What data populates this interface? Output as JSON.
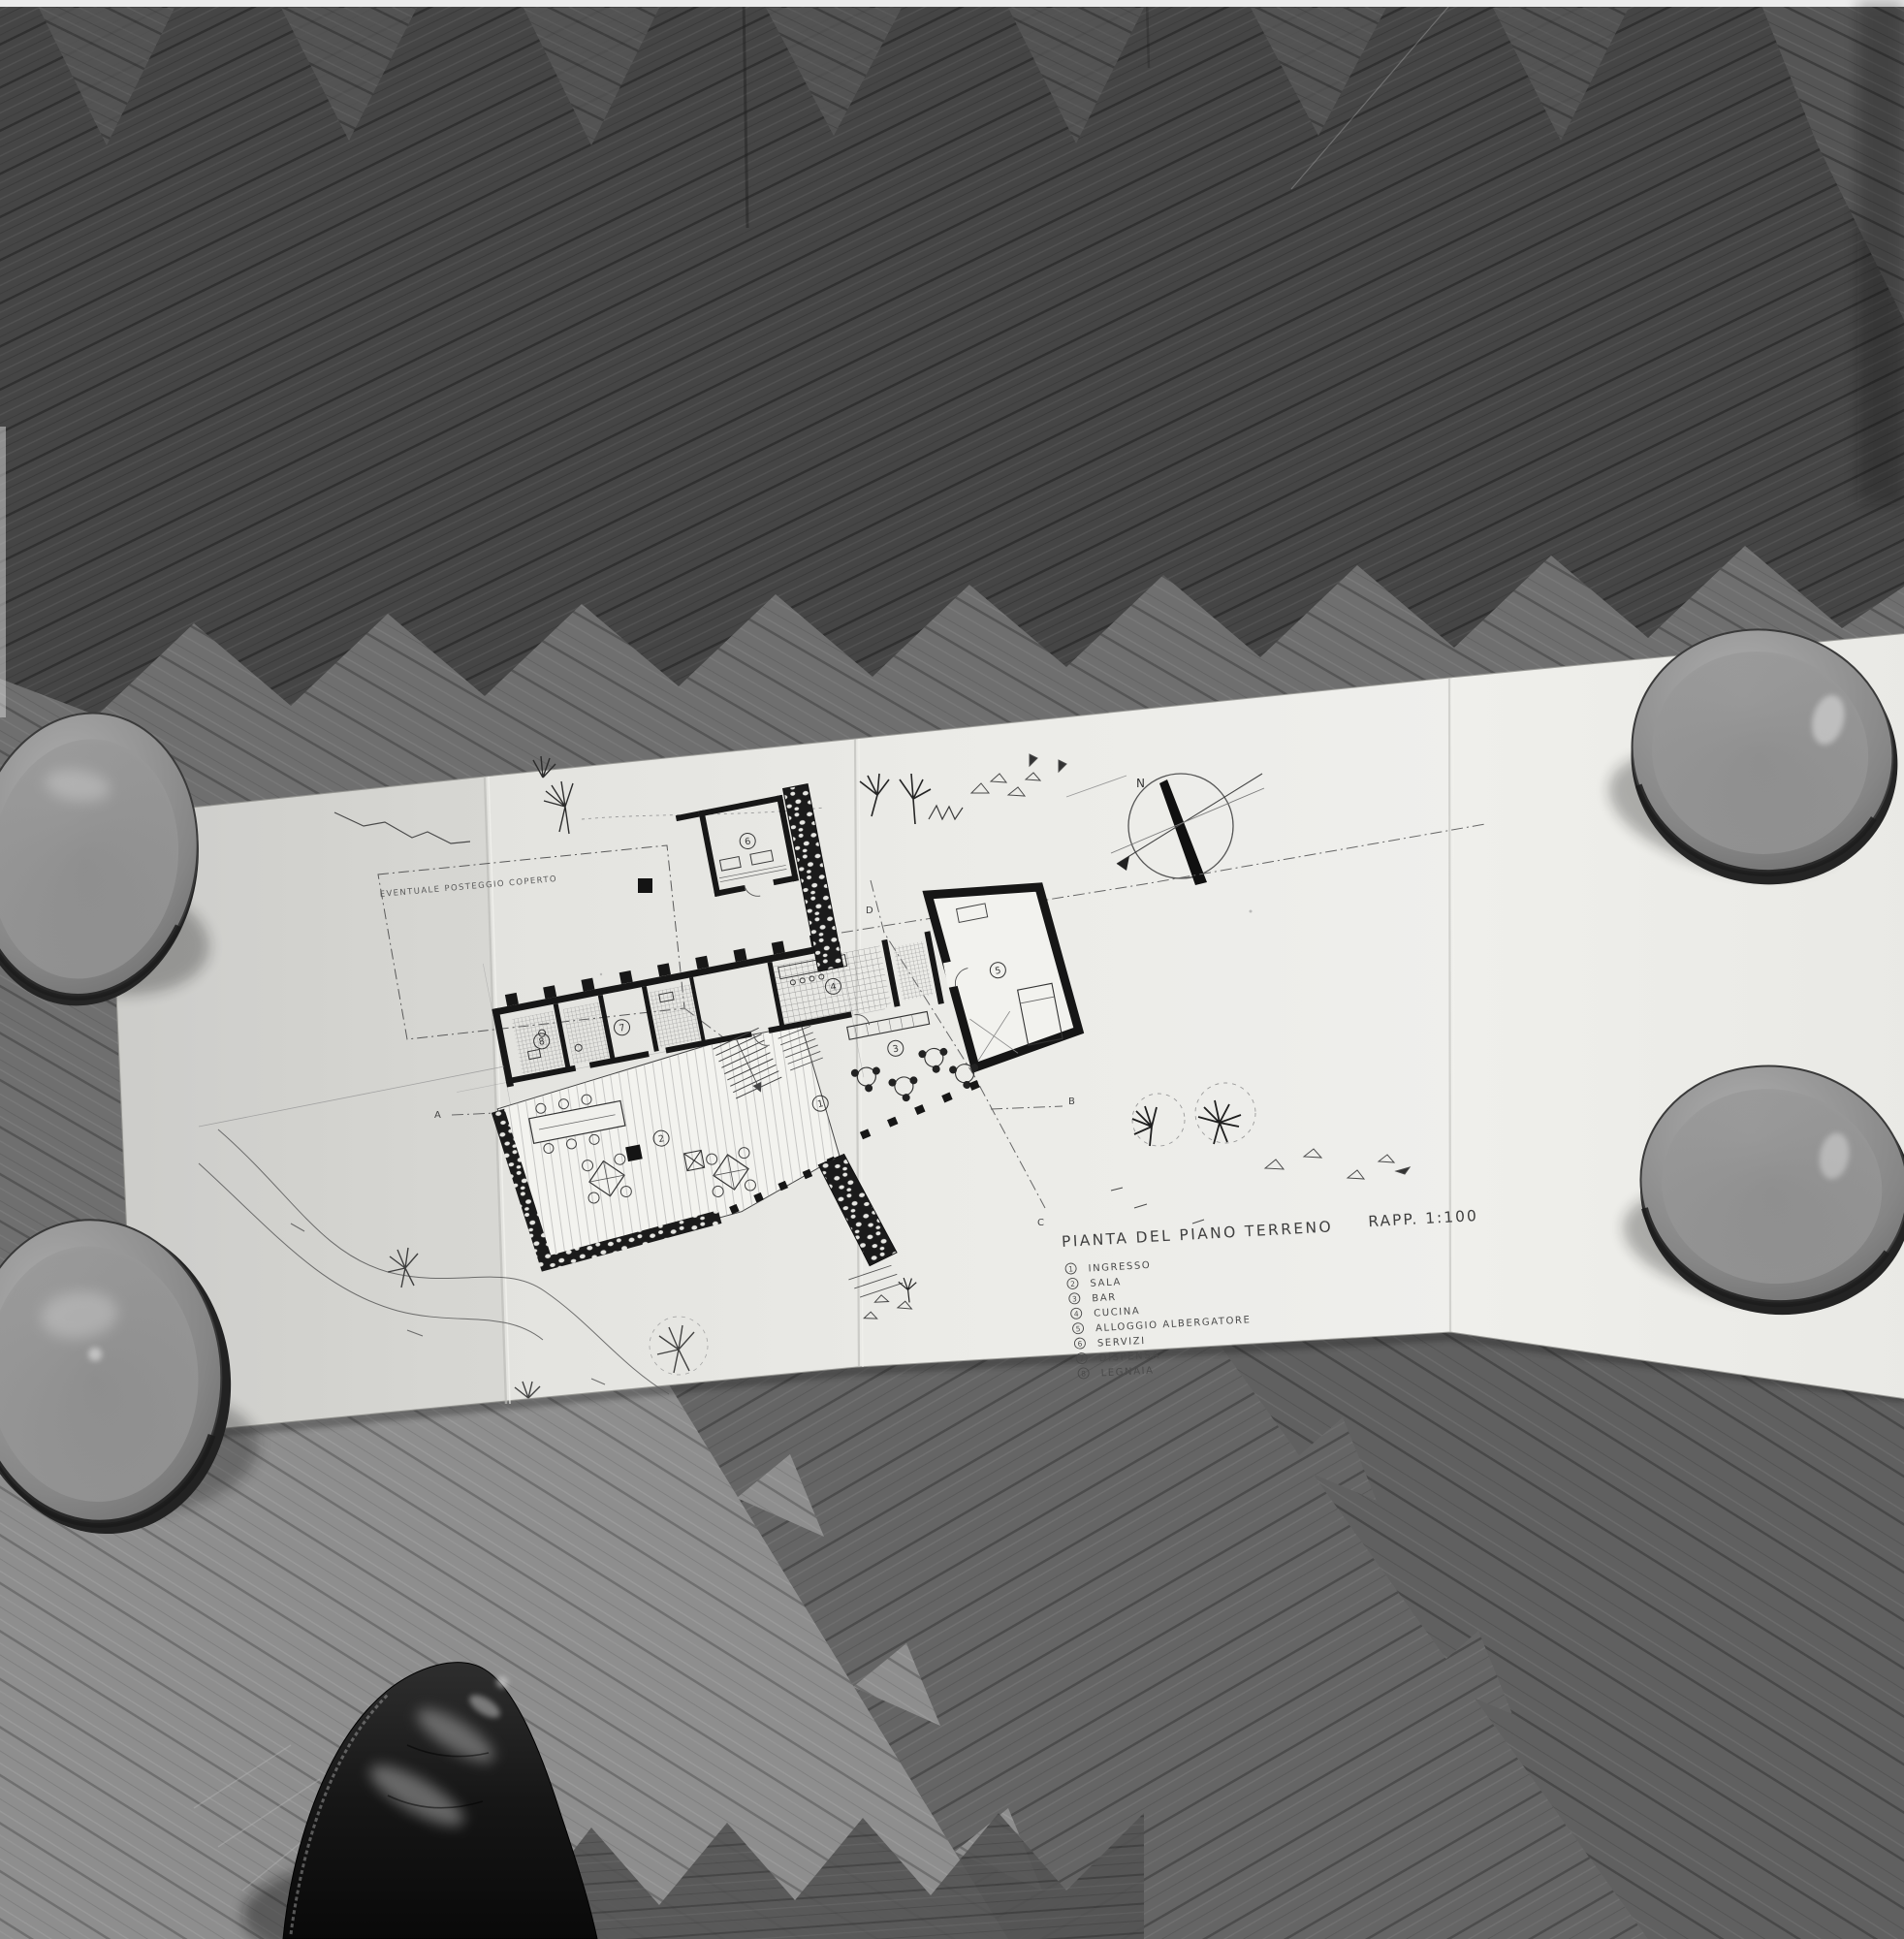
{
  "drawing": {
    "title": "PIANTA DEL PIANO TERRENO",
    "scale_label": "RAPP. 1:100",
    "annotation_parking": "EVENTUALE POSTEGGIO COPERTO",
    "compass_north": "N",
    "section_markers": {
      "a": "A",
      "b": "B",
      "c": "C",
      "d": "D"
    },
    "legend": {
      "items": [
        {
          "num": "1",
          "label": "INGRESSO"
        },
        {
          "num": "2",
          "label": "SALA"
        },
        {
          "num": "3",
          "label": "BAR"
        },
        {
          "num": "4",
          "label": "CUCINA"
        },
        {
          "num": "5",
          "label": "ALLOGGIO ALBERGATORE"
        },
        {
          "num": "6",
          "label": "SERVIZI"
        },
        {
          "num": "7",
          "label": "DISPENSA"
        },
        {
          "num": "8",
          "label": "LEGNAIA"
        }
      ]
    }
  },
  "scene": {
    "floor": "herringbone-parquet-floor",
    "paper": "folded-architectural-drawing-sheet",
    "paperweights": "ceramic-bowls",
    "foreground": "black-leather-shoe-toe"
  },
  "colors": {
    "floor_dark": "#474747",
    "floor_light": "#8e8e8e",
    "paper": "#eaeae6",
    "ink": "#3c3c3c",
    "bowl": "#9a9a9a",
    "shoe": "#141414"
  }
}
